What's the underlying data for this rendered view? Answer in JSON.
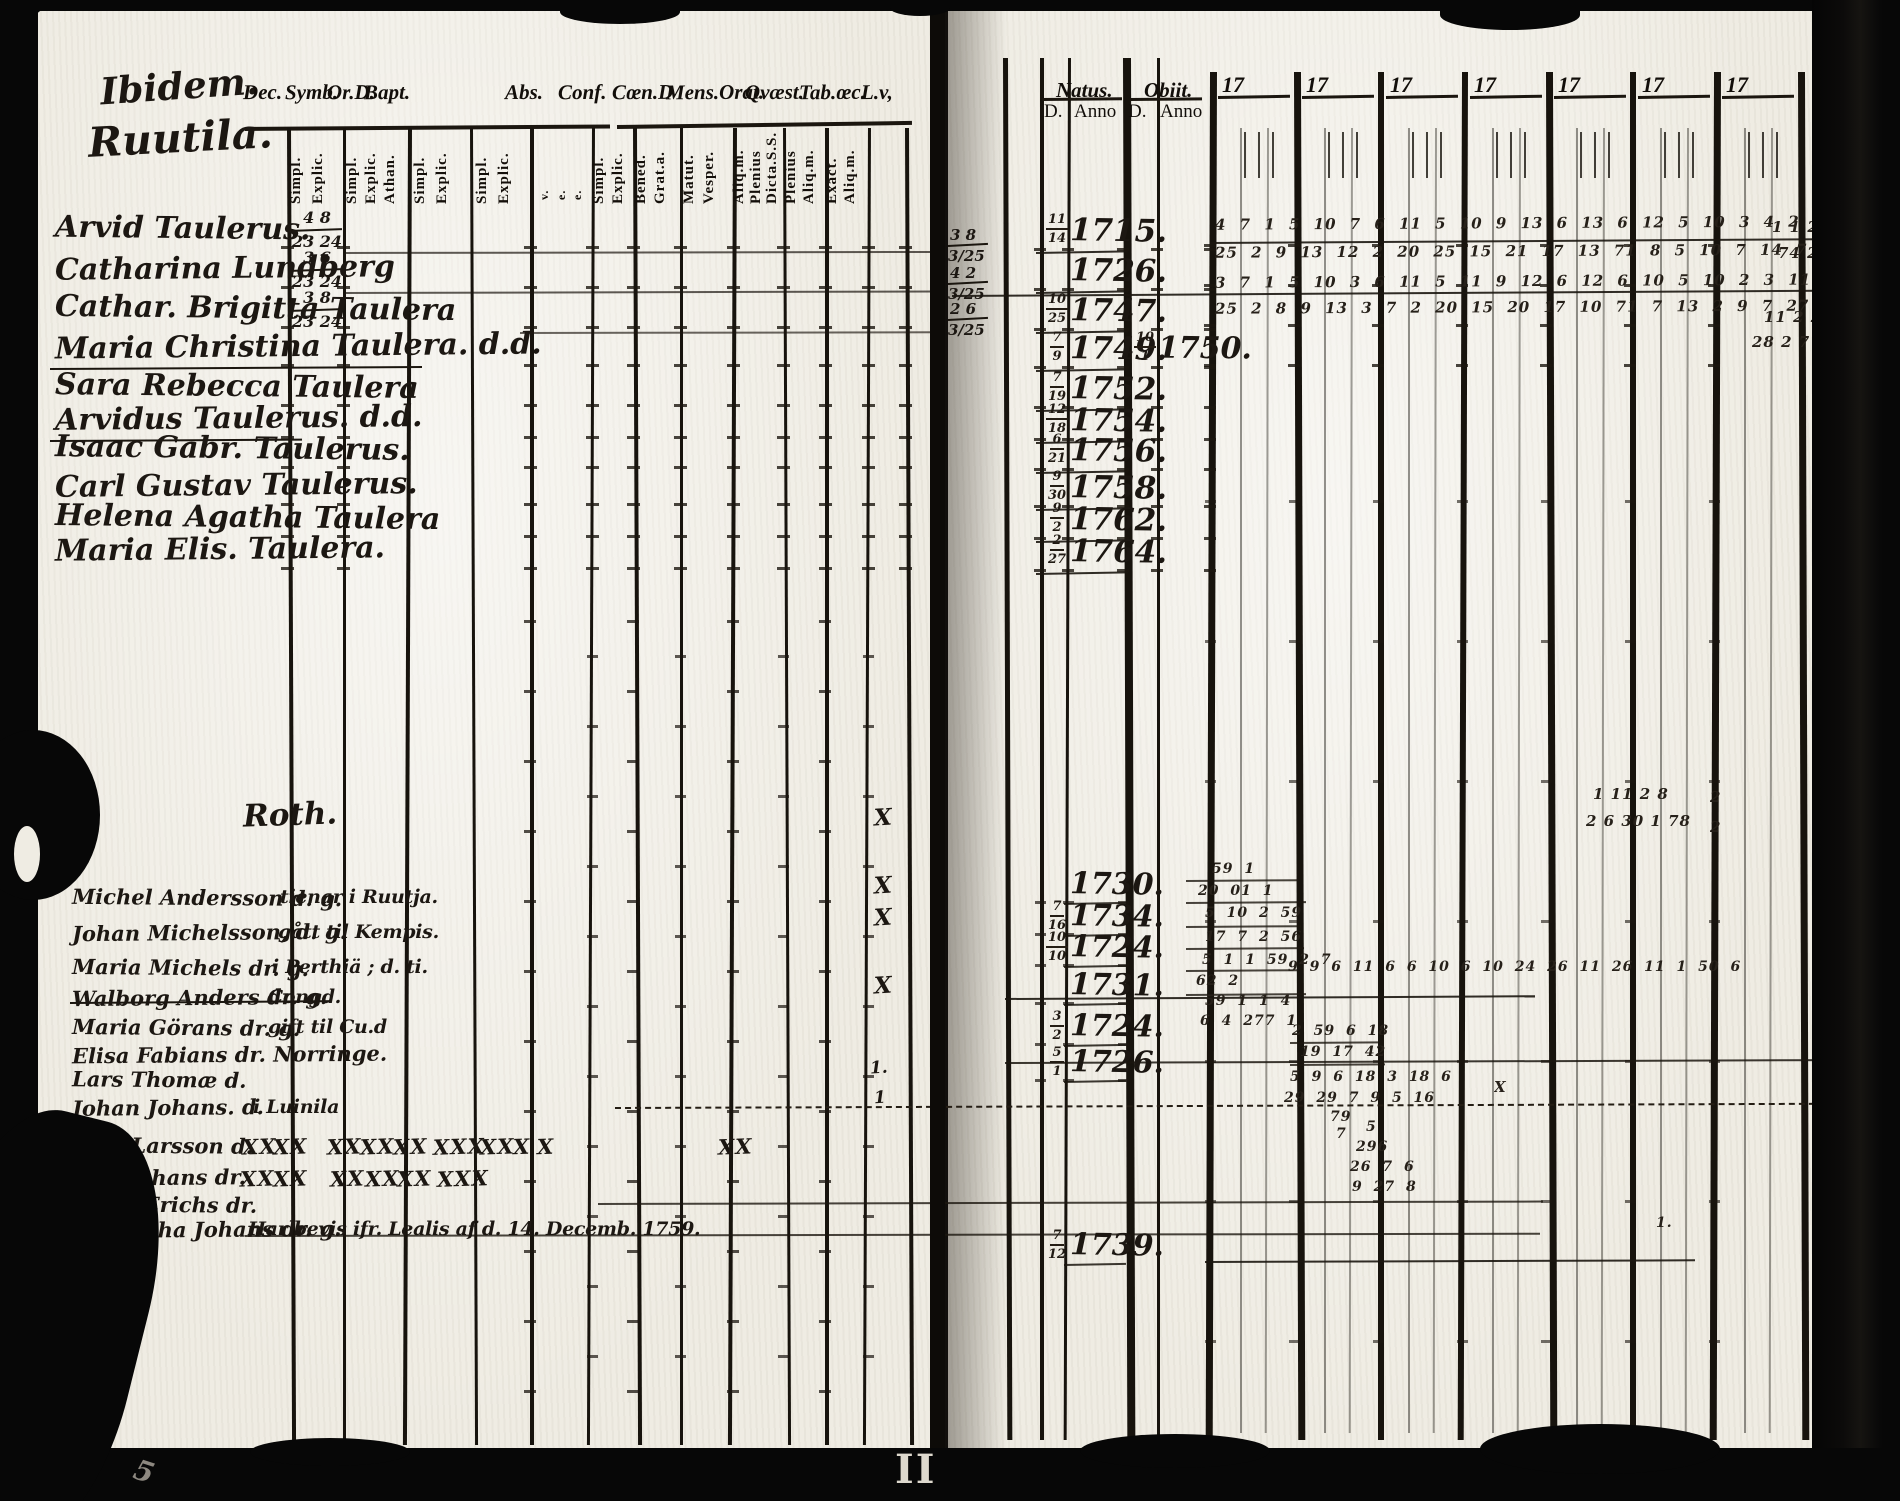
{
  "document": {
    "left_page": {
      "place_heading_line1": "Ibidem.",
      "place_heading_line2": "Ruutila.",
      "printed_column_headers": [
        "Dec.",
        "Symb.",
        "Or.D.",
        "Bapt.",
        "Abs.",
        "Conf.",
        "Cœn.D",
        "Mens.Orat.",
        "Qvæst.",
        "Tab.œc.",
        "L.v,"
      ],
      "rotated_subheaders": [
        {
          "labels": [
            "Simpl.",
            "Explic."
          ]
        },
        {
          "labels": [
            "Simpl.",
            "Explic.",
            "Athan."
          ]
        },
        {
          "labels": [
            "Simpl.",
            "Explic."
          ]
        },
        {
          "labels": [
            "Simpl.",
            "Explic."
          ]
        },
        {
          "labels": [
            "v.",
            "e.",
            "e."
          ]
        },
        {
          "labels": [
            "Simpl.",
            "Explic."
          ]
        },
        {
          "labels": [
            "Bened.",
            "Grat.a."
          ]
        },
        {
          "labels": [
            "Matut.",
            "Vesper."
          ]
        },
        {
          "labels": [
            "Aliq.m.",
            "Plenius",
            "Dicta.S.S."
          ]
        },
        {
          "labels": [
            "Plenius",
            "Aliq.m."
          ]
        },
        {
          "labels": [
            "Exact.",
            "Aliq.m."
          ]
        }
      ],
      "household_entries": [
        {
          "name": "Arvid Taulerus.",
          "grade_top": "4 8",
          "grade_bottom": "23 24"
        },
        {
          "name": "Catharina Lundberg",
          "grade_top": "3 6",
          "grade_bottom": "23 24"
        },
        {
          "name": "Cathar. Brigitta Taulera",
          "grade_top": "3 8",
          "grade_bottom": "23 24"
        },
        {
          "name": "Maria Christina Taulera. d.d."
        },
        {
          "name": "Sara Rebecca Taulera"
        },
        {
          "name": "Arvidus Taulerus. d.d."
        },
        {
          "name": "Isaac Gabr. Taulerus."
        },
        {
          "name": "Carl Gustav Taulerus."
        },
        {
          "name": "Helena Agatha Taulera"
        },
        {
          "name": "Maria Elis. Taulera."
        }
      ],
      "section_heading": "Roth.",
      "roth_entries": [
        {
          "name": "Michel Andersson d. g.",
          "note": "tienar i Ruutja."
        },
        {
          "name": "Johan Michelsson, d. g.",
          "note": "gått til Kempis."
        },
        {
          "name": "Maria Michels dr. g.",
          "note": "i Perthiä ; d. ti."
        },
        {
          "name": "Walborg Anders dr. g.",
          "note": "Congd."
        },
        {
          "name": "Maria Görans dr. g.",
          "note": "gift til Cu.d"
        },
        {
          "name": "Elisa Fabians dr. Norringe.",
          "note": ""
        },
        {
          "name": "Lars Thomæ d.",
          "note": ""
        },
        {
          "name": "Johan Johans. d.",
          "note": "i Luinila"
        },
        {
          "name": "Paul Larsson d.",
          "note": "",
          "marks": [
            "XX",
            "XX",
            "XX",
            "XX",
            "XX",
            "XXX",
            "XX",
            "X",
            "X",
            "XX"
          ]
        },
        {
          "name": "Lisa Johans dr.",
          "note": "",
          "marks": [
            "XX",
            "XX",
            "XX",
            "XX",
            "XX",
            "XXX"
          ]
        },
        {
          "name": "Lucia Erichs dr.",
          "note": ""
        },
        {
          "name": "Margetha Johans dr. g.",
          "note": "Har bevis ifr. Lealis af d. 14. Decemb. 1759."
        }
      ],
      "margin_x_marks": [
        "X",
        "X",
        "X",
        "X",
        "1.",
        "1"
      ]
    },
    "right_page": {
      "natus_header": "Natus.",
      "obiit_header": "Obiit.",
      "day_anno_headers": [
        "D.",
        "Anno",
        "D.",
        "Anno"
      ],
      "year_column_headers": [
        "17",
        "17",
        "17",
        "17",
        "17",
        "17",
        "17"
      ],
      "gutter_fractions": [
        {
          "top": "3 8",
          "bottom": "3/25"
        },
        {
          "top": "4 2",
          "bottom": "3/25"
        },
        {
          "top": "2 6",
          "bottom": "3/25"
        }
      ],
      "birth_records": [
        {
          "day_top": "11",
          "day_bottom": "14",
          "anno": "1715."
        },
        {
          "day_top": "",
          "day_bottom": "",
          "anno": "1726."
        },
        {
          "day_top": "10",
          "day_bottom": "25",
          "anno": "1747."
        },
        {
          "day_top": "7",
          "day_bottom": "9",
          "anno": "1749.",
          "obiit_day_top": "10",
          "obiit_day_bottom": "1",
          "obiit_anno": "1750."
        },
        {
          "day_top": "7",
          "day_bottom": "19",
          "anno": "1752."
        },
        {
          "day_top": "12",
          "day_bottom": "18",
          "anno": "1754."
        },
        {
          "day_top": "6",
          "day_bottom": "21",
          "anno": "1756."
        },
        {
          "day_top": "9",
          "day_bottom": "30",
          "anno": "1758."
        },
        {
          "day_top": "9",
          "day_bottom": "2",
          "anno": "1762."
        },
        {
          "day_top": "2",
          "day_bottom": "27",
          "anno": "1764."
        }
      ],
      "attendance_scrawl": [
        "4 7  1 5 10  7 6  11  5  10    9 13  6 13  6 12     5 10 3 4   2 7   1 17  1 11  10 10",
        "25 2  9 13  12 2 20 25  15  21 17 13 71   8 5 10 7 14   7 2   7 2  1 14 11  10 18",
        "3 7  1 5 10  3 6  11  5  11    9 12  6 12  6 10     5 10 2 3   11 2   7 1   2 8",
        "25 2  8 9 13  3 7 2 20 15   20 17 10 71    7 13 2 9   7 27   1 21  1 11  7 18  9 8"
      ],
      "roth_birth_records": [
        {
          "day_top": "",
          "day_bottom": "",
          "anno": "1730."
        },
        {
          "day_top": "7",
          "day_bottom": "16",
          "anno": "1734."
        },
        {
          "day_top": "10",
          "day_bottom": "10",
          "anno": "1724."
        },
        {
          "day_top": "",
          "day_bottom": "",
          "anno": "1731."
        },
        {
          "day_top": "3",
          "day_bottom": "2",
          "anno": "1724."
        },
        {
          "day_top": "5",
          "day_bottom": "1",
          "anno": "1726."
        },
        {
          "day_top": "7",
          "day_bottom": "12",
          "anno": "1739."
        }
      ],
      "roth_scrawl": [
        "59 1",
        "20 01 1",
        "5 10 2 59",
        "17 7 2 56",
        "5 1 1 59 2 7",
        "62 2",
        "59 1 1 4",
        "6 4 277 1",
        "9 9 6 11 6 6 10 6 10 24 26 11 26 11 1 50 6",
        "2 59 6 18",
        "19 17 42",
        "5 9 6 18 3 18 6",
        "29 29 7 9 5 16",
        "79",
        "7",
        "5",
        "296",
        "26 7 6",
        "9 27 8",
        "1."
      ],
      "stray_marks": [
        "1 11 2 8",
        "2 6 30 1 78",
        "2",
        "2",
        "1 1 2 4 2",
        "74 2",
        "11 2 27",
        "28 2 7 78",
        "X"
      ]
    },
    "page_mark": "II",
    "corner_scribble": "5"
  }
}
